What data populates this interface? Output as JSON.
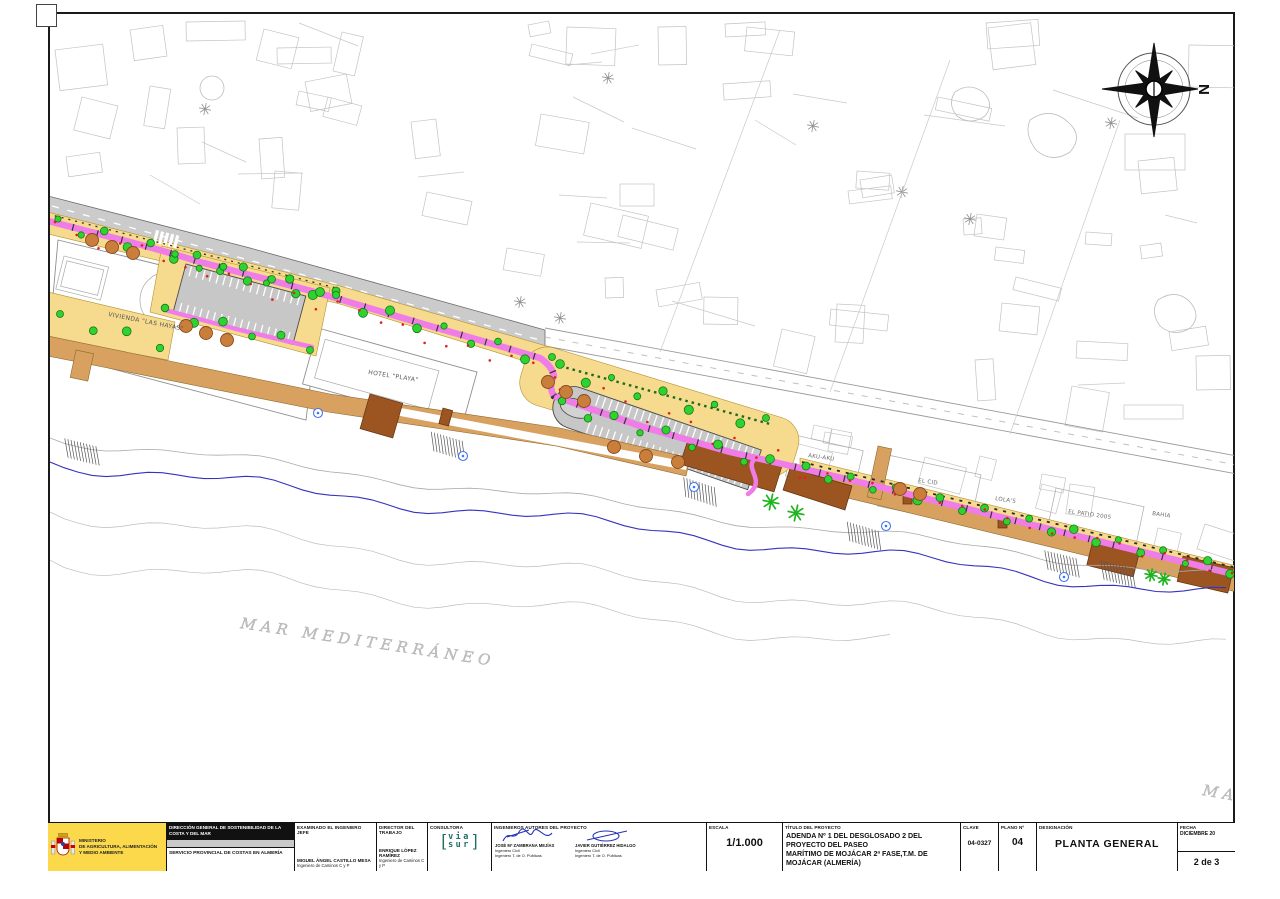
{
  "plan": {
    "north_label": "N",
    "sea_label": "MAR MEDITERRÁNEO",
    "sea_label_partial": "MA",
    "labels": {
      "vivienda": "VIVIENDA \"LAS HAYAS\"",
      "hotel": "HOTEL \"PLAYA\"",
      "akuaku": "AKU-AKU",
      "el_cid": "EL CID",
      "lolas": "LOLA'S",
      "el_patio": "EL PATIO 2005",
      "bahia": "BAHÍA"
    }
  },
  "title_block": {
    "ministry": {
      "line1": "MINISTERIO",
      "line2": "DE AGRICULTURA, ALIMENTACIÓN",
      "line3": "Y MEDIO AMBIENTE"
    },
    "direccion_general": "DIRECCIÓN GENERAL DE SOSTENIBILIDAD DE LA COSTA Y DEL MAR",
    "servicio_provincial": "SERVICIO PROVINCIAL DE COSTAS EN ALMERÍA",
    "examinado": {
      "label": "EXAMINADO EL INGENIERO JEFE",
      "name": "MIGUEL ÁNGEL CASTILLO MESA",
      "title": "Ingeniero de Caminos C y P"
    },
    "director": {
      "label": "DIRECTOR DEL TRABAJO",
      "name": "ENRIQUE LÓPEZ RAMÍREZ",
      "title": "Ingeniero de Caminos C y P"
    },
    "consultora": {
      "label": "CONSULTORA",
      "logo_top": "via",
      "logo_bottom": "sur"
    },
    "ingenieros": {
      "label": "INGENIEROS AUTORES DEL PROYECTO",
      "engineer1": {
        "name": "JOSÉ Mª ZAMBRANA MEJÍAS",
        "line1": "Ingeniero Civil",
        "line2": "Ingeniero T. de O. Públicas"
      },
      "engineer2": {
        "name": "JAVIER GUTIÉRREZ HIDALGO",
        "line1": "Ingeniero Civil",
        "line2": "Ingeniero T. de O. Públicas"
      }
    },
    "escala": {
      "label": "ESCALA",
      "value": "1/1.000"
    },
    "titulo": {
      "label": "TÍTULO DEL PROYECTO",
      "line1": "ADENDA Nº 1 DEL DESGLOSADO 2 DEL PROYECTO DEL PASEO",
      "line2": "MARÍTIMO DE MOJÁCAR 2ª FASE,T.M. DE MOJÁCAR (ALMERÍA)"
    },
    "clave": {
      "label": "CLAVE",
      "value": "04-0327"
    },
    "plano": {
      "label": "PLANO Nº",
      "value": "04"
    },
    "designacion": {
      "label": "DESIGNACIÓN",
      "value": "PLANTA GENERAL"
    },
    "fecha": {
      "label": "FECHA",
      "value": "DICIEMBRE 20",
      "sheet": "2 de 3"
    }
  },
  "colors": {
    "promenade_yellow": "#F6DA8D",
    "path_pink": "#F07CE8",
    "parking_gray": "#C7C7C7",
    "road_gray": "#CBCBCB",
    "boardwalk_tan": "#D8A160",
    "deck_brown": "#9C5420",
    "tree_green": "#2FD32F",
    "canopy_orange": "#C97F3B",
    "shore_blue": "#3434BE",
    "marker_blue": "#4477EE",
    "ministry_yellow": "#FBD94B",
    "viasur_teal": "#1F6F63",
    "signature_blue": "#2433B8"
  }
}
